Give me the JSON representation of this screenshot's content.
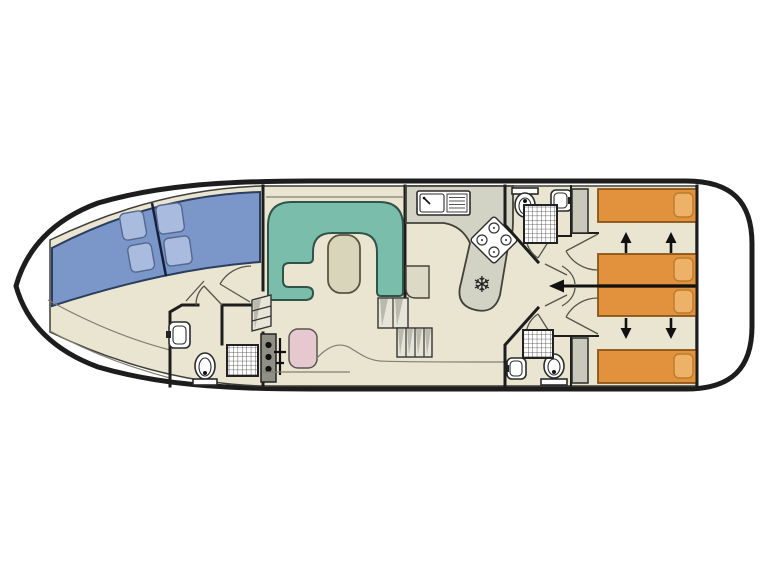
{
  "page": {
    "background": "#ffffff",
    "figure": "boat-deck-plan"
  },
  "palette": {
    "page_bg": "#ffffff",
    "wall": "#1d1d1d",
    "floor": "#eae5d0",
    "bed_blue": "#7b96c8",
    "pillow_blue": "#a9bcdf",
    "bed_orange": "#e2913c",
    "pillow_orange": "#eeb168",
    "sofa_teal": "#7abdab",
    "table_beige": "#d9d5ba",
    "counter_grey": "#d3d3c5",
    "wardrobe_grey": "#c9c9bb",
    "chair_pink": "#e6c8d0",
    "console_grey": "#8f8f86",
    "step_light": "#e7e5d7",
    "step_shade": "#b9b9ad"
  },
  "icons": {
    "freezer": "❄"
  },
  "plan": {
    "bow_cabin": {
      "beds": 2,
      "bed_color": "blue",
      "pillows": 4,
      "bench_curves": 2
    },
    "forward_bathroom": {
      "toilet": 1,
      "washbasin": 1,
      "shower": 1
    },
    "saloon": {
      "u_sofa": 1,
      "table": 1,
      "helm_console_knobs": 3,
      "helm_seat": 1,
      "step_flights": 2
    },
    "galley": {
      "sink_with_drainer": 1,
      "hob_burners": 4,
      "freezer": 1
    },
    "top_bathroom": {
      "toilet": 1,
      "washbasin": 1,
      "shower": 1
    },
    "bottom_bathroom": {
      "toilet": 1,
      "washbasin": 1,
      "shower": 1
    },
    "wardrobes": 2,
    "stern_cabins": {
      "beds": 4,
      "bed_color": "orange",
      "pillows": 4,
      "convert_arrows_up": 2,
      "convert_arrows_down": 2,
      "slide_arrow_left": 1
    }
  }
}
